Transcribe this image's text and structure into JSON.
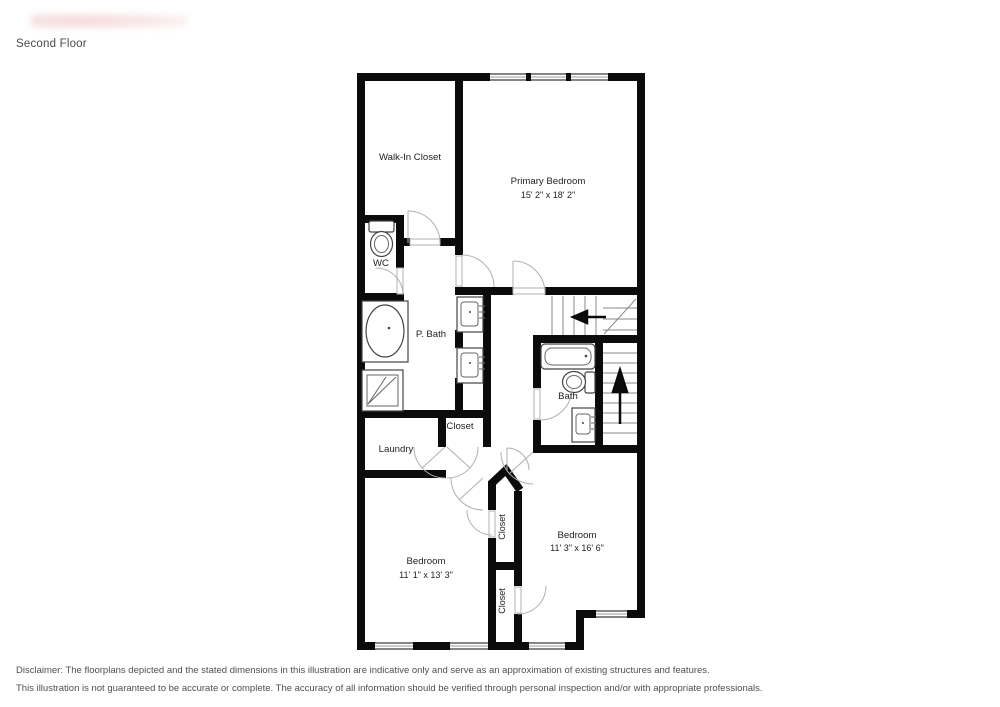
{
  "page": {
    "title": "Second Floor"
  },
  "floorplan": {
    "rooms": {
      "walk_in_closet": {
        "label": "Walk-In Closet"
      },
      "primary_bedroom": {
        "label": "Primary Bedroom",
        "dimensions": "15' 2\" x 18' 2\""
      },
      "wc": {
        "label": "WC"
      },
      "p_bath": {
        "label": "P. Bath"
      },
      "bath": {
        "label": "Bath"
      },
      "laundry": {
        "label": "Laundry"
      },
      "closet_hall": {
        "label": "Closet"
      },
      "closet_upper": {
        "label": "Closet"
      },
      "closet_lower": {
        "label": "Closet"
      },
      "bedroom_left": {
        "label": "Bedroom",
        "dimensions": "11' 1\" x 13' 3\""
      },
      "bedroom_right": {
        "label": "Bedroom",
        "dimensions": "11' 3\" x 16' 6\""
      }
    },
    "stairs": {
      "direction_up": "up-arrow",
      "direction_turn": "left-arrow"
    }
  },
  "disclaimer": {
    "line1": "Disclaimer: The floorplans depicted and the stated dimensions in this illustration are indicative only and serve as an approximation of existing structures and features.",
    "line2": "This illustration is not guaranteed to be accurate or complete. The accuracy of all information should be verified through personal inspection and/or with appropriate professionals."
  }
}
